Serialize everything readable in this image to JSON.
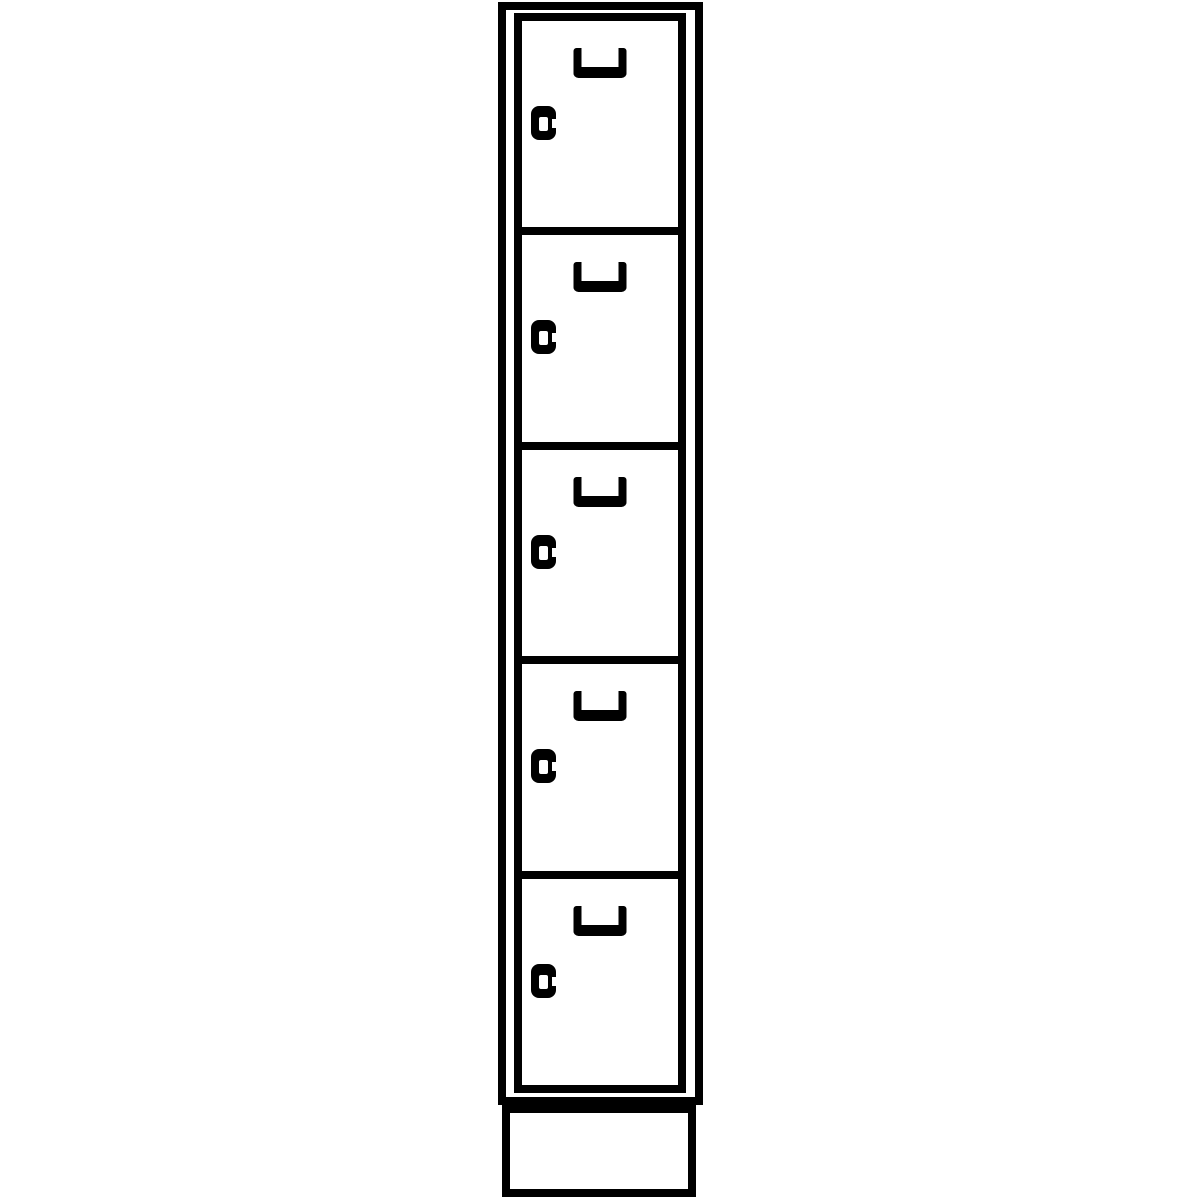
{
  "drawing": {
    "kind": "product-line-drawing",
    "subject": "single-column compartment locker, front elevation",
    "compartment_count": 5,
    "colors": {
      "line": "#000000",
      "background": "#ffffff"
    },
    "parts": {
      "cabinet": "outer cabinet frame",
      "door_column": "column of hinged compartment doors",
      "door": "compartment door",
      "handle": "recessed U-shaped pull handle",
      "lock": "cylinder lock",
      "plinth": "plinth base"
    },
    "icons": {
      "handle": "u-handle-icon",
      "lock": "cylinder-lock-icon"
    }
  }
}
